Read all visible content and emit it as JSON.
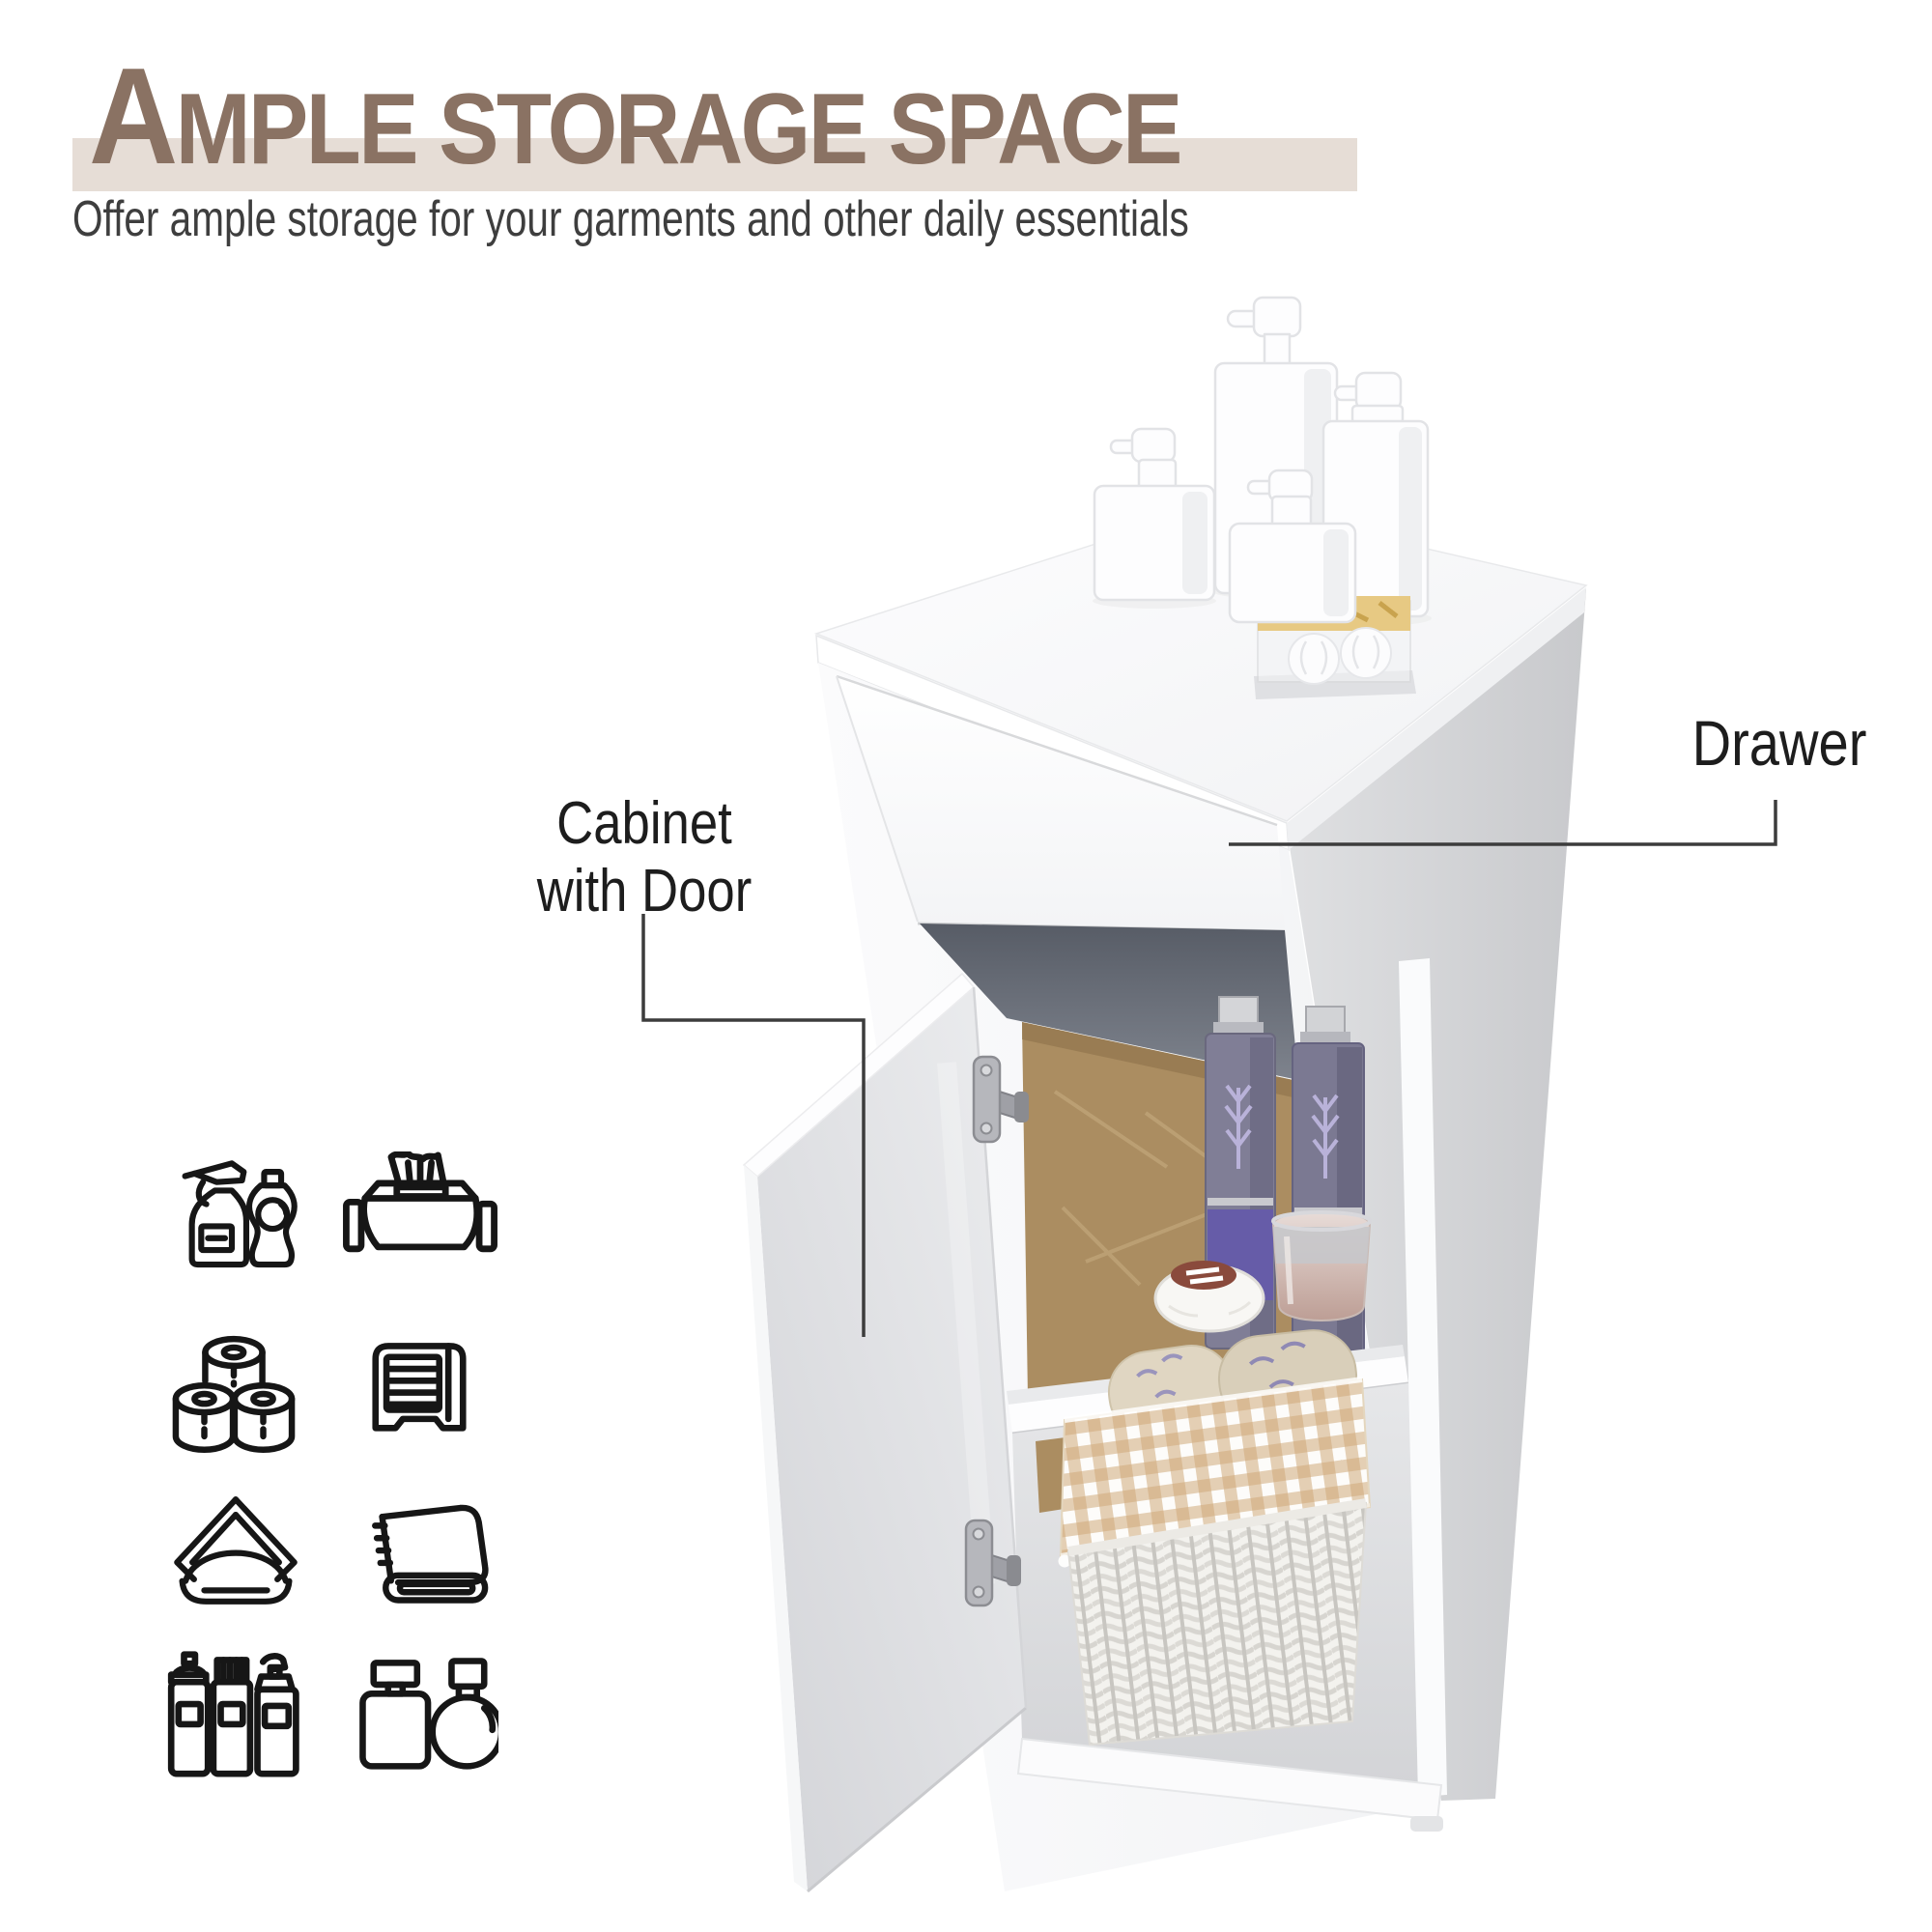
{
  "header": {
    "title_drop_cap": "A",
    "title_rest": "MPLE STORAGE SPACE",
    "subtitle": "Offer ample storage for your garments and other daily essentials",
    "title_color": "#8a7263",
    "highlight_band_color": "#e6ddd6",
    "subtitle_color": "#3e3e3e"
  },
  "callouts": {
    "drawer": {
      "label": "Drawer"
    },
    "cabinet": {
      "label_line1": "Cabinet",
      "label_line2": "with Door"
    },
    "line_color": "#3c3c3c"
  },
  "feature_icons": [
    {
      "name": "cleaning-spray-and-soap-icon"
    },
    {
      "name": "wet-wipes-icon"
    },
    {
      "name": "toilet-paper-rolls-icon"
    },
    {
      "name": "towel-dispenser-icon"
    },
    {
      "name": "napkin-holder-icon"
    },
    {
      "name": "folded-towel-icon"
    },
    {
      "name": "toiletry-bottles-icon"
    },
    {
      "name": "perfume-bottles-icon"
    }
  ],
  "scene": {
    "description": "White bathroom floor cabinet: closed top drawer, open lower door showing shelf with lavender toiletry bottles, glass cup and soap, and a wicker basket of towels below; four white pump bottles and a boxed soap-ball set on top",
    "cabinet_white": "#fafbfc",
    "side_panel_gray": "#ced0d3",
    "recess_gray": "#646974",
    "back_panel_brown": "#ab8d61",
    "bottle_lavender": "#7e7c94",
    "bottle_label_purple": "#665ca8",
    "gingham_tan": "#cfa97a",
    "towel_beige": "#ddd3c0"
  }
}
